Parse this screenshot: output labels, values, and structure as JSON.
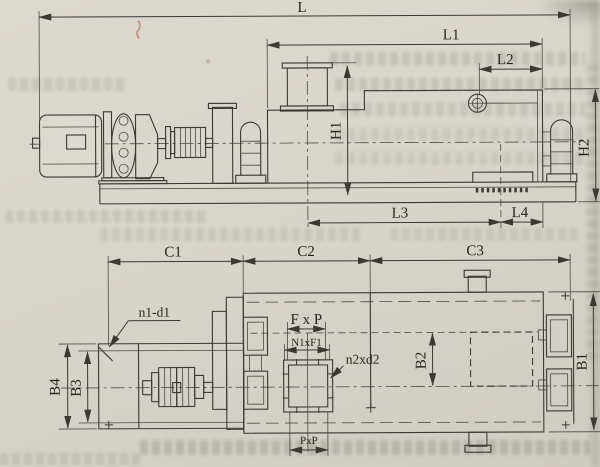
{
  "labels": {
    "L": "L",
    "L1": "L1",
    "L2": "L2",
    "L3": "L3",
    "L4": "L4",
    "H1": "H1",
    "H2": "H2",
    "C1": "C1",
    "C2": "C2",
    "C3": "C3",
    "B1": "B1",
    "B2": "B2",
    "B3": "B3",
    "B4": "B4",
    "n1d1": "n1-d1",
    "FxP": "F x P",
    "N1xF1": "N1xF1",
    "n2xd2": "n2xd2",
    "PxP": "PxP"
  },
  "colors": {
    "paper": "#d8d5cc",
    "ink": "#3a3935",
    "pen_mark": "#b3582a"
  }
}
